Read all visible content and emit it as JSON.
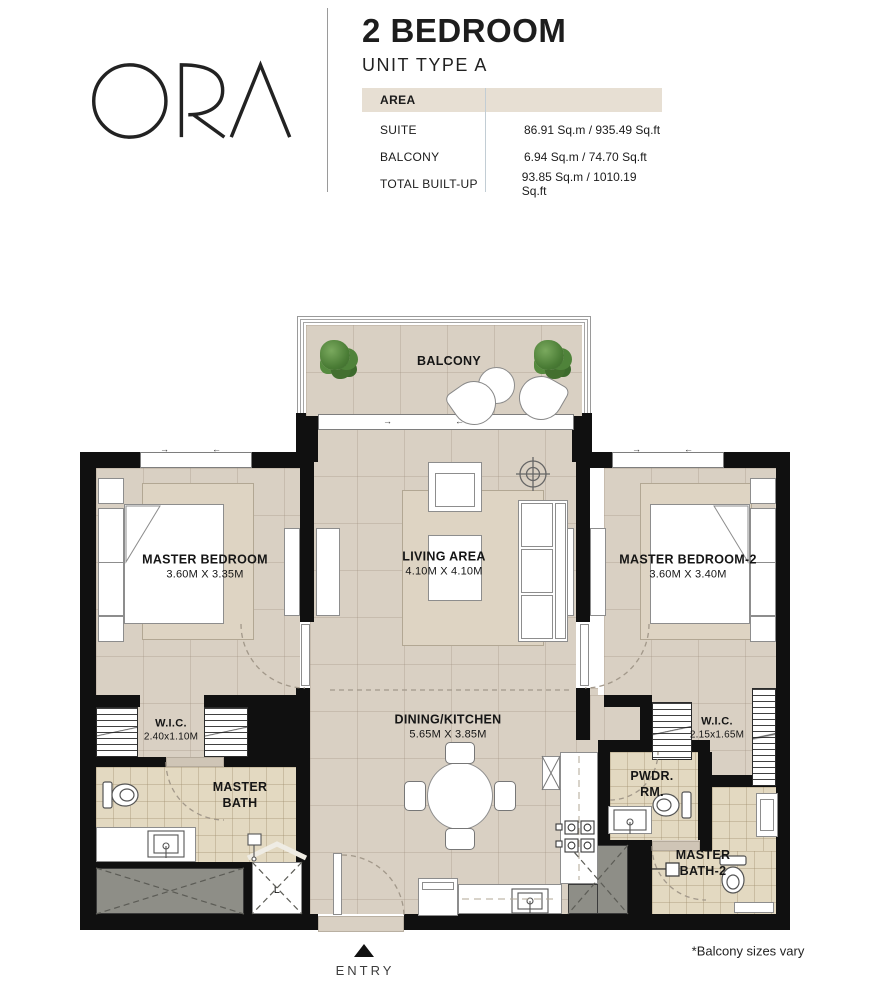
{
  "brand": {
    "logo_text": "ORA"
  },
  "header": {
    "title": "2 BEDROOM",
    "subtitle": "UNIT TYPE A"
  },
  "area_table": {
    "header_label": "AREA",
    "rows": [
      {
        "label": "SUITE",
        "value": "86.91 Sq.m / 935.49 Sq.ft"
      },
      {
        "label": "BALCONY",
        "value": "6.94 Sq.m / 74.70 Sq.ft"
      },
      {
        "label": "TOTAL BUILT-UP",
        "value": "93.85 Sq.m / 1010.19 Sq.ft"
      }
    ]
  },
  "rooms": {
    "balcony": {
      "name": "BALCONY"
    },
    "master_bedroom": {
      "name": "MASTER BEDROOM",
      "dims": "3.60M X 3.35M"
    },
    "living": {
      "name": "LIVING AREA",
      "dims": "4.10M X 4.10M"
    },
    "master_bedroom_2": {
      "name": "MASTER BEDROOM-2",
      "dims": "3.60M X 3.40M"
    },
    "dining_kitchen": {
      "name": "DINING/KITCHEN",
      "dims": "5.65M X 3.85M"
    },
    "wic_1": {
      "name": "W.I.C.",
      "dims": "2.40x1.10M"
    },
    "master_bath": {
      "name": "MASTER BATH"
    },
    "pwdr": {
      "name": "PWDR. RM."
    },
    "wic_2": {
      "name": "W.I.C.",
      "dims": "2.15x1.65M"
    },
    "master_bath_2": {
      "name": "MASTER BATH-2"
    }
  },
  "plan": {
    "entry_label": "ENTRY",
    "laundry_label": "L",
    "arrow_right": "→",
    "arrow_left": "←"
  },
  "footer": {
    "note": "*Balcony sizes vary"
  },
  "colors": {
    "accent_beige": "#e7dfd3",
    "wall": "#101010",
    "floor": "#d9d0c3",
    "bath_tile": "#e3d9c1",
    "shaft_gray": "#8e8e87",
    "plant_green": "#4a7c35"
  }
}
